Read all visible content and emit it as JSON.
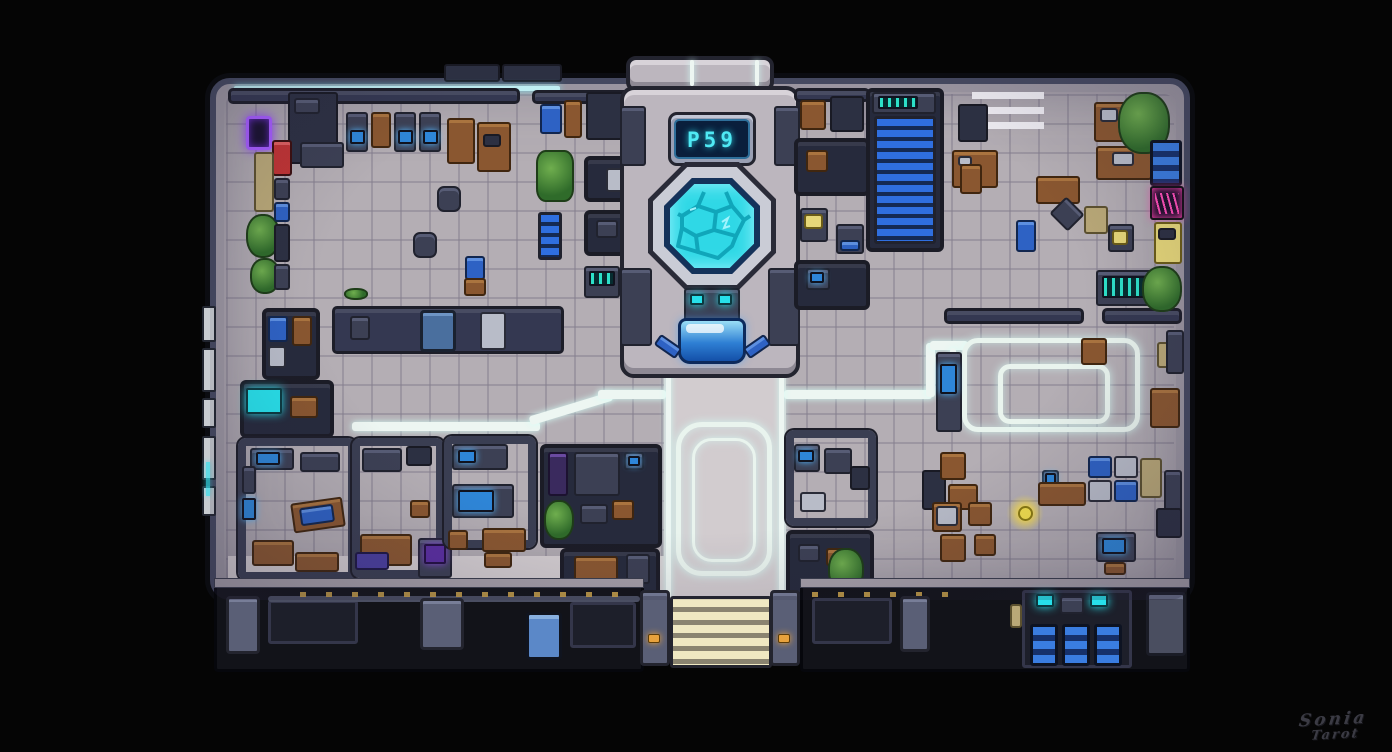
{
  "scene": {
    "description": "pixel-art top-down sci-fi station floor map",
    "display_text": "P59"
  },
  "signature": {
    "line1": "Sonia",
    "line2": "Tarot"
  },
  "colors": {
    "background": "#050505",
    "floor": "#b4aeb4",
    "walkway": "#d2cccf",
    "outer_wall": "#454960",
    "room_wall": "#343851",
    "glow_path_white": "#edf6f2",
    "pool_cyan": "#2fd8e6",
    "display_cyan": "#4fe9f4",
    "terminal_blue": "#2e7fd4",
    "escalator_blue": "#2f6fe0",
    "neon_purple": "#a65cff",
    "neon_pink": "#ff4fb8",
    "vending_red": "#c13434",
    "vending_yellow": "#e6d779",
    "wood_brown": "#8a5730",
    "plant_green": "#4e8a3a",
    "amber_light": "#e8a23c",
    "steps_cream": "#efe8c2",
    "crate_blue": "#2e62c4"
  }
}
